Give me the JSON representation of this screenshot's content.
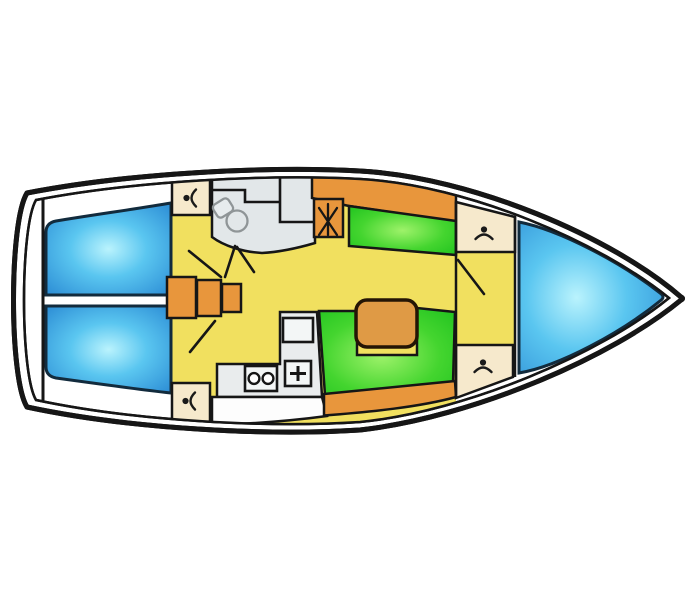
{
  "figure": {
    "kind": "sailboat-interior-deck-plan-top-view-bow-right",
    "background": "#ffffff",
    "hull_fill": "#ffffff",
    "outline_color": "#161616",
    "colors": {
      "floor_yellow": "#f1e05f",
      "berth_blue_center": "#baf3fd",
      "berth_blue_mid": "#5ac6f0",
      "berth_blue_edge": "#2e8fd6",
      "settee_green_center": "#9ef26a",
      "settee_green_mid": "#44d52f",
      "settee_green_edge": "#1ec21e",
      "trim_orange": "#e8963c",
      "table_orange": "#df9a45",
      "locker_cream": "#f6e9cc",
      "head_gray": "#e2e7e9",
      "galley_gray": "#e9eced",
      "fixture_gray": "#f3f6f6",
      "counter_white": "#fdfdfd",
      "icon_ink": "#1a1a1a",
      "toilet_outline": "#8f9597"
    },
    "icons": {
      "wardrobe": "wardrobe-hanger-icon",
      "toilet": "toilet-icon",
      "mast": "mast-icon",
      "stove": "two-burner-stove-icon",
      "sink": "sink-plus-icon",
      "door": "door-swing-line"
    }
  }
}
